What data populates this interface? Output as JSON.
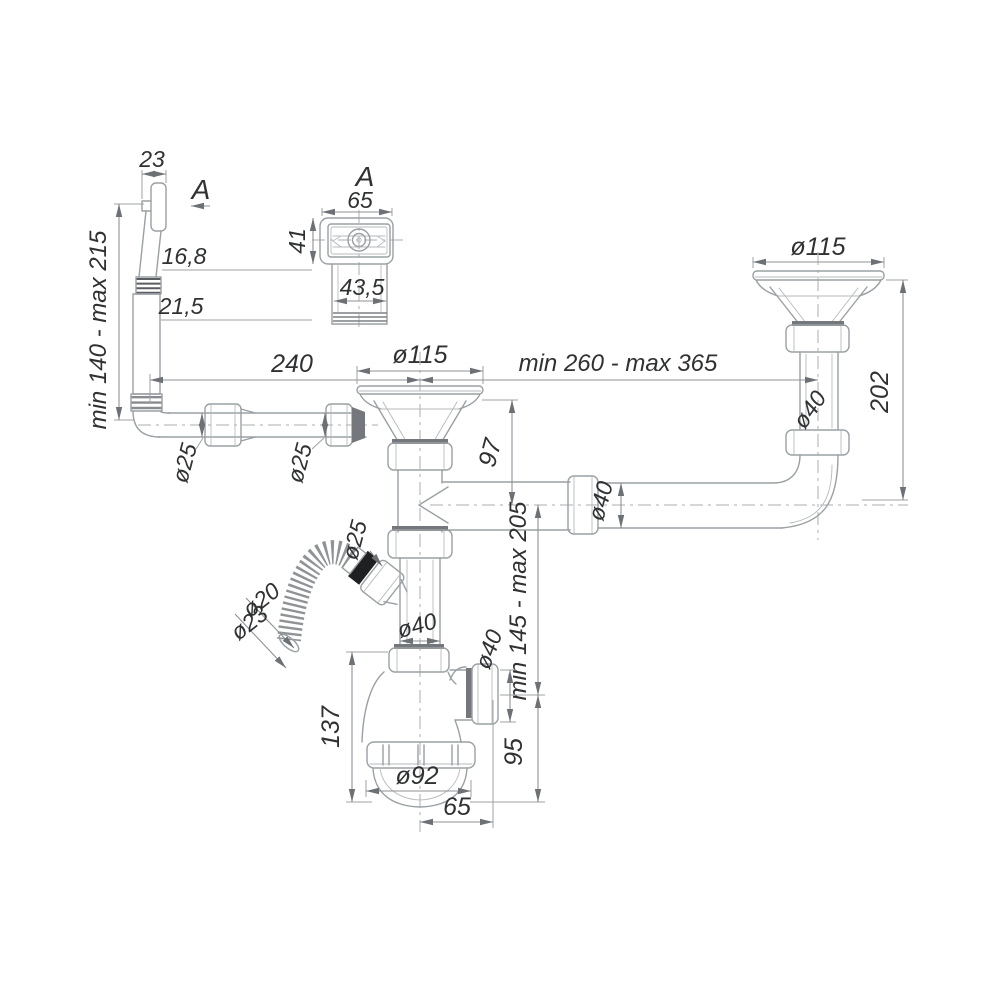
{
  "drawing": {
    "type": "technical-diagram",
    "subject": "Double-bowl kitchen sink bottle-trap siphon with overflow and washing-machine branch — dimensional drawing",
    "view_labels": {
      "section_arrow": "A",
      "detail_title": "A"
    },
    "dims": {
      "head_width": "23",
      "overflow_range": "min 140 - max 215",
      "thread_od": "16,8",
      "tube_od": "21,5",
      "span_left": "240",
      "center_strainer_dia": "ø115",
      "span_right": "min 260 - max 365",
      "right_strainer_dia": "ø115",
      "right_drop": "202",
      "right_pipe_dia": "ø40",
      "overflow_pipe_dia_1": "ø25",
      "overflow_pipe_dia_2": "ø25",
      "branch_drop": "97",
      "branch_pipe_dia": "ø40",
      "hose_joint_dia": "ø25",
      "hose_inner_dia": "ø20",
      "hose_outer_dia": "ø23",
      "trap_range": "min 145 - max 205",
      "trap_inlet_dia": "ø40",
      "trap_outlet_dia": "ø40",
      "trap_height": "137",
      "outlet_drop": "95",
      "cup_dia": "ø92",
      "outlet_offset": "65",
      "detail_width": "65",
      "detail_height": "41",
      "detail_neck": "43,5"
    },
    "colors": {
      "line": "#9aa0a4",
      "dimension": "#8f9296",
      "text": "#2f3133",
      "seal": "#1f2022",
      "bg": "#ffffff"
    }
  }
}
